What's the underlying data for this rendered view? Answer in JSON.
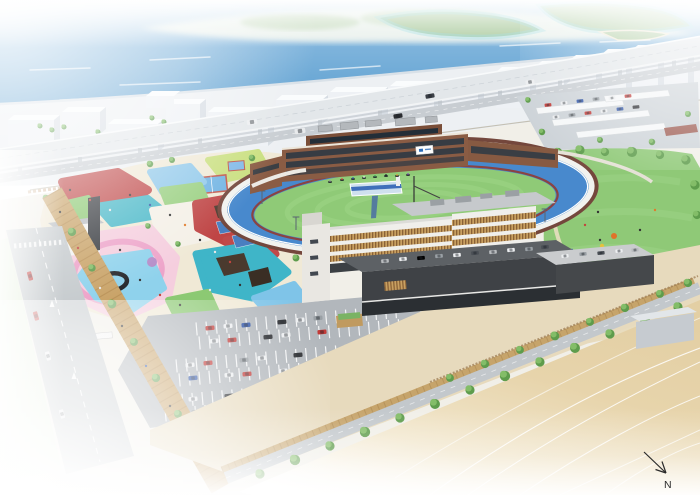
{
  "scene": {
    "description": "aerial-architectural-rendering-of-seaside-velodrome-sports-park",
    "regions": [
      "sea",
      "distant-islands",
      "city-blocks",
      "elevated-expressway",
      "velodrome-track",
      "grandstand",
      "main-building",
      "playground-park",
      "water-play-park",
      "parking-lot",
      "canopy-parking",
      "east-lawn-park",
      "tree-lined-road",
      "boardwalk",
      "sand-open-area",
      "plaza"
    ]
  },
  "compass": {
    "label": "N"
  },
  "palette": {
    "sea": "#5b9ed2",
    "island_green": "#a9c99b",
    "city_front": "#eef1f5",
    "highway": "#e3e7ea",
    "track_blue": "#4889cd",
    "track_wall": "#74473c",
    "infield_green": "#8fca77",
    "lawn_green": "#8fc977",
    "stand_brown": "#8a5c44",
    "stand_glass": "#2d3944",
    "building_white": "#f0efeb",
    "louver_wood": "#c8a061",
    "podium_dark": "#3f4246",
    "park_red": "#c04a4a",
    "park_teal": "#3fb5c8",
    "park_blue": "#7fc4e8",
    "park_pink": "#f5cede",
    "pink_path": "#ec9fc6",
    "pool_blue": "#8fd2ec",
    "park_green": "#98cf7f",
    "park_yellow_green": "#c9df7e",
    "park_cream": "#f0e9d6",
    "boardwalk": "#c9a368",
    "asphalt": "#b2b7bc",
    "sand": "#e3cfa4",
    "car_red": "#c23b38",
    "car_blue": "#2f55a8",
    "car_white": "#eceef0",
    "car_black": "#2b2d31",
    "car_silver": "#9aa0a5"
  }
}
